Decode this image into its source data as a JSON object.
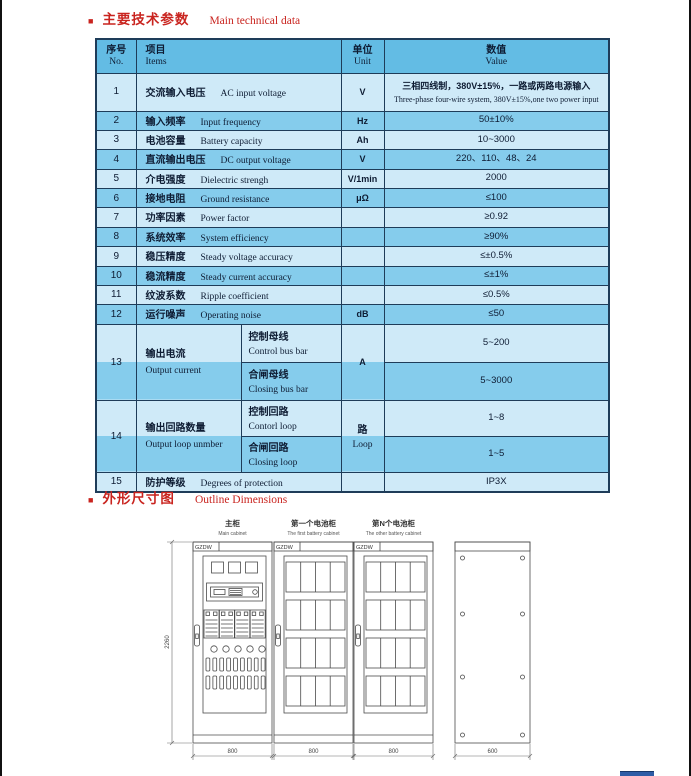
{
  "colors": {
    "accent_red": "#c9241f",
    "table_header_bg": "#63bce4",
    "row_light": "#cfeaf8",
    "row_dark": "#85ccec",
    "table_border": "#1e3c59",
    "footer_bar_blue": "#2e5ca6"
  },
  "sections": {
    "tech": {
      "bullet": "■",
      "title_zh": "主要技术参数",
      "title_en": "Main technical data"
    },
    "outline": {
      "bullet": "■",
      "title_zh": "外形尺寸图",
      "title_en": "Outline Dimensions"
    }
  },
  "table": {
    "header": {
      "no_zh": "序号",
      "no_en": "No.",
      "items_zh": "项目",
      "items_en": "Items",
      "unit_zh": "单位",
      "unit_en": "Unit",
      "value_zh": "数值",
      "value_en": "Value"
    },
    "rows": [
      {
        "no": "1",
        "item_zh": "交流输入电压",
        "item_en": "AC input voltage",
        "unit": "V",
        "value_zh": "三相四线制，380V±15%，一路或两路电源输入",
        "value_en": "Three-phase four-wire system, 380V±15%,one two power input"
      },
      {
        "no": "2",
        "item_zh": "输入频率",
        "item_en": "Input frequency",
        "unit": "Hz",
        "value": "50±10%"
      },
      {
        "no": "3",
        "item_zh": "电池容量",
        "item_en": "Battery capacity",
        "unit": "Ah",
        "value": "10~3000"
      },
      {
        "no": "4",
        "item_zh": "直流输出电压",
        "item_en": "DC output voltage",
        "unit": "V",
        "value": "220、110、48、24"
      },
      {
        "no": "5",
        "item_zh": "介电强度",
        "item_en": "Dielectric strengh",
        "unit": "V/1min",
        "value": "2000"
      },
      {
        "no": "6",
        "item_zh": "接地电阻",
        "item_en": "Ground resistance",
        "unit": "μΩ",
        "value": "≤100"
      },
      {
        "no": "7",
        "item_zh": "功率因素",
        "item_en": "Power factor",
        "unit": "",
        "value": "≥0.92"
      },
      {
        "no": "8",
        "item_zh": "系统效率",
        "item_en": "System efficiency",
        "unit": "",
        "value": "≥90%"
      },
      {
        "no": "9",
        "item_zh": "稳压精度",
        "item_en": "Steady voltage accuracy",
        "unit": "",
        "value": "≤±0.5%"
      },
      {
        "no": "10",
        "item_zh": "稳流精度",
        "item_en": "Steady current accuracy",
        "unit": "",
        "value": "≤±1%"
      },
      {
        "no": "11",
        "item_zh": "纹波系数",
        "item_en": "Ripple coefficient",
        "unit": "",
        "value": "≤0.5%"
      },
      {
        "no": "12",
        "item_zh": "运行噪声",
        "item_en": "Operating noise",
        "unit": "dB",
        "value": "≤50"
      },
      {
        "no": "13",
        "item_zh": "输出电流",
        "item_en": "Output current",
        "unit": "A",
        "subs": [
          {
            "zh": "控制母线",
            "en": "Control bus bar",
            "value": "5~200"
          },
          {
            "zh": "合闸母线",
            "en": "Closing bus bar",
            "value": "5~3000"
          }
        ]
      },
      {
        "no": "14",
        "item_zh": "输出回路数量",
        "item_en": "Output loop unmber",
        "unit_zh": "路",
        "unit_en": "Loop",
        "subs": [
          {
            "zh": "控制回路",
            "en": "Contorl loop",
            "value": "1~8"
          },
          {
            "zh": "合闸回路",
            "en": "Closing loop",
            "value": "1~5"
          }
        ]
      },
      {
        "no": "15",
        "item_zh": "防护等级",
        "item_en": "Degrees of protection",
        "unit": "",
        "value": "IP3X"
      }
    ]
  },
  "drawings": {
    "cabinets": [
      {
        "label_zh": "主柜",
        "label_en": "Main cabinet",
        "tag": "GZDW",
        "width_dim": "800"
      },
      {
        "label_zh": "第一个电池柜",
        "label_en": "The first battery cabinet",
        "tag": "GZDW",
        "width_dim": "800"
      },
      {
        "label_zh": "第N个电池柜",
        "label_en": "The other battery cabinet",
        "tag": "GZDW",
        "width_dim": "800"
      }
    ],
    "side": {
      "width_dim": "600"
    },
    "height_dim": "2260"
  }
}
